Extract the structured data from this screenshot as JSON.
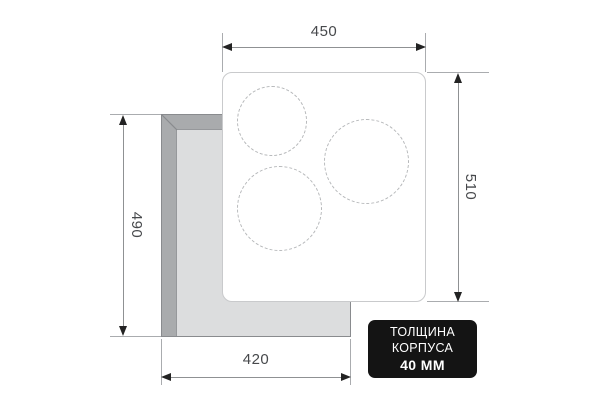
{
  "meta": {
    "title": "Cooktop installation dimensions diagram"
  },
  "dimensions": {
    "panel_width": "450",
    "panel_height": "510",
    "cutout_height": "490",
    "cutout_width": "420"
  },
  "badge": {
    "line1": "ТОЛЩИНА",
    "line2": "КОРПУСА",
    "line3": "40 ММ"
  },
  "colors": {
    "badge_bg": "#141414",
    "badge_text": "#ffffff",
    "cutout_dark_gray": "#a9abad",
    "cutout_light_gray": "#dcddde",
    "panel_bg": "#ffffff",
    "panel_border": "#c9cacc",
    "burner_dash": "#b6b8ba",
    "dimension_line": "#8f9193",
    "arrowhead": "#232323",
    "dimension_text": "#47494c"
  }
}
